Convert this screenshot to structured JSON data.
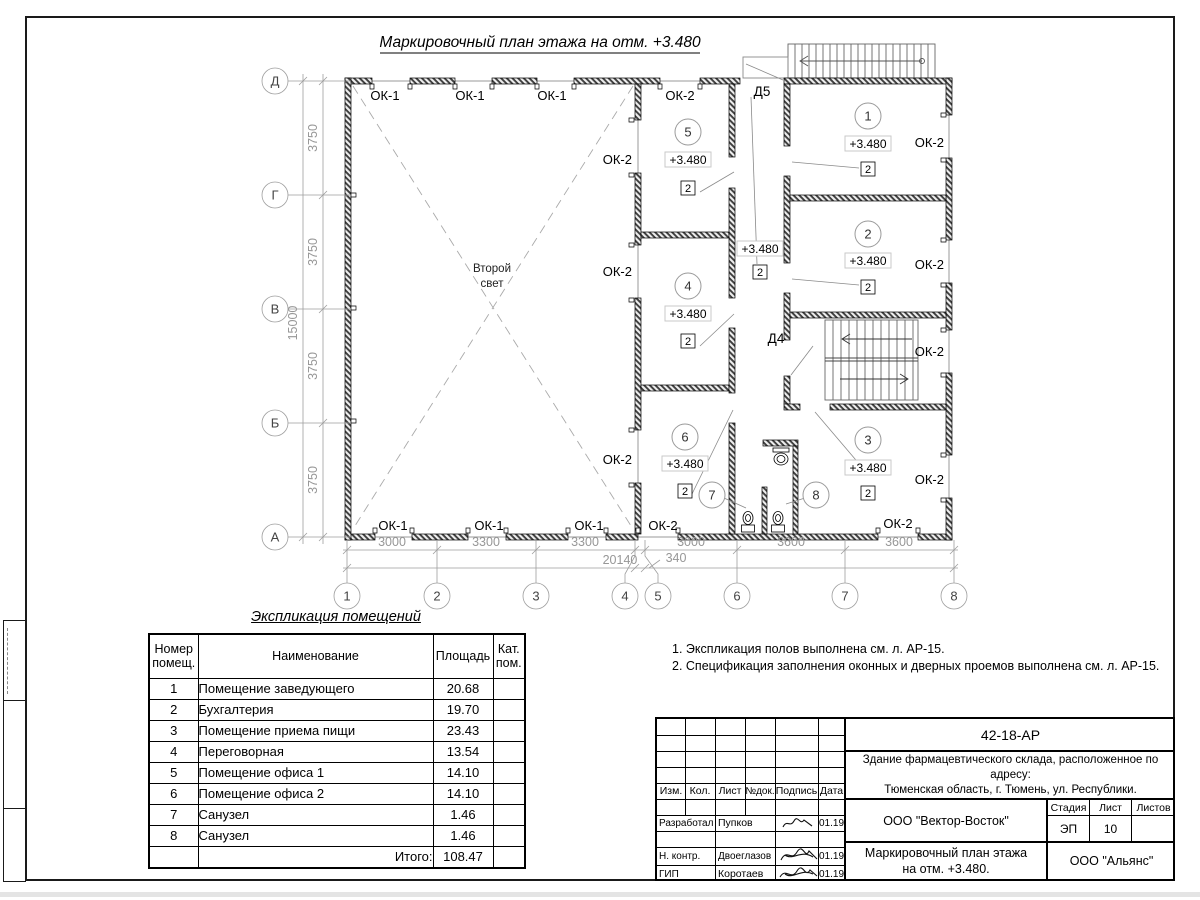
{
  "title": "Маркировочный план этажа на отм. +3.480",
  "plan": {
    "second_light_line1": "Второй",
    "second_light_line2": "свет",
    "elevation": "+3.480",
    "door_mark": "2",
    "window_labels": {
      "ok1": "ОК-1",
      "ok2": "ОК-2"
    },
    "door_labels": {
      "d4": "Д4",
      "d5": "Д5"
    },
    "rooms": [
      "1",
      "2",
      "3",
      "4",
      "5",
      "6",
      "7",
      "8"
    ],
    "axes_letters": [
      "Д",
      "Г",
      "В",
      "Б",
      "А"
    ],
    "axes_numbers": [
      "1",
      "2",
      "3",
      "4",
      "5",
      "6",
      "7",
      "8"
    ],
    "dims_left": [
      "3750",
      "3750",
      "3750",
      "3750"
    ],
    "dim_left_total": "15000",
    "dims_bottom": [
      "3000",
      "3300",
      "3300",
      "3000",
      "3600",
      "3600"
    ],
    "dim_bottom_total": "20140",
    "dim_bottom_offset": "340"
  },
  "expl": {
    "title": "Экспликация помещений",
    "headers": {
      "num": "Номер помещ.",
      "name": "Наименование",
      "area": "Площадь",
      "cat": "Кат. пом."
    },
    "rows": [
      {
        "num": "1",
        "name": "Помещение заведующего",
        "area": "20.68",
        "cat": ""
      },
      {
        "num": "2",
        "name": "Бухгалтерия",
        "area": "19.70",
        "cat": ""
      },
      {
        "num": "3",
        "name": "Помещение приема пищи",
        "area": "23.43",
        "cat": ""
      },
      {
        "num": "4",
        "name": "Переговорная",
        "area": "13.54",
        "cat": ""
      },
      {
        "num": "5",
        "name": "Помещение офиса 1",
        "area": "14.10",
        "cat": ""
      },
      {
        "num": "6",
        "name": "Помещение офиса 2",
        "area": "14.10",
        "cat": ""
      },
      {
        "num": "7",
        "name": "Санузел",
        "area": "1.46",
        "cat": ""
      },
      {
        "num": "8",
        "name": "Санузел",
        "area": "1.46",
        "cat": ""
      }
    ],
    "total_label": "Итого:",
    "total": "108.47"
  },
  "notes": {
    "line1": "1. Экспликация полов выполнена см. л. АР-15.",
    "line2": "2. Спецификация заполнения оконных и дверных проемов выполнена см. л. АР-15."
  },
  "titleblock": {
    "doc_code": "42-18-АР",
    "building_line1": "Здание фармацевтического склада, расположенное по адресу:",
    "building_line2": "Тюменская область, г. Тюмень, ул. Республики.",
    "col_headers": [
      "Изм.",
      "Кол.",
      "Лист",
      "№док.",
      "Подпись",
      "Дата"
    ],
    "sign_rows": [
      {
        "role": "Разработал",
        "name": "Пупков",
        "date": "01.19"
      },
      {
        "role": "Н. контр.",
        "name": "Двоеглазов",
        "date": "01.19"
      },
      {
        "role": "ГИП",
        "name": "Коротаев",
        "date": "01.19"
      }
    ],
    "org": "ООО \"Вектор-Восток\"",
    "stage_label": "Стадия",
    "sheet_label": "Лист",
    "sheets_label": "Листов",
    "stage": "ЭП",
    "sheet": "10",
    "sheets": "",
    "sheet_title_line1": "Маркировочный план этажа",
    "sheet_title_line2": "на отм. +3.480.",
    "org2": "ООО \"Альянс\""
  }
}
